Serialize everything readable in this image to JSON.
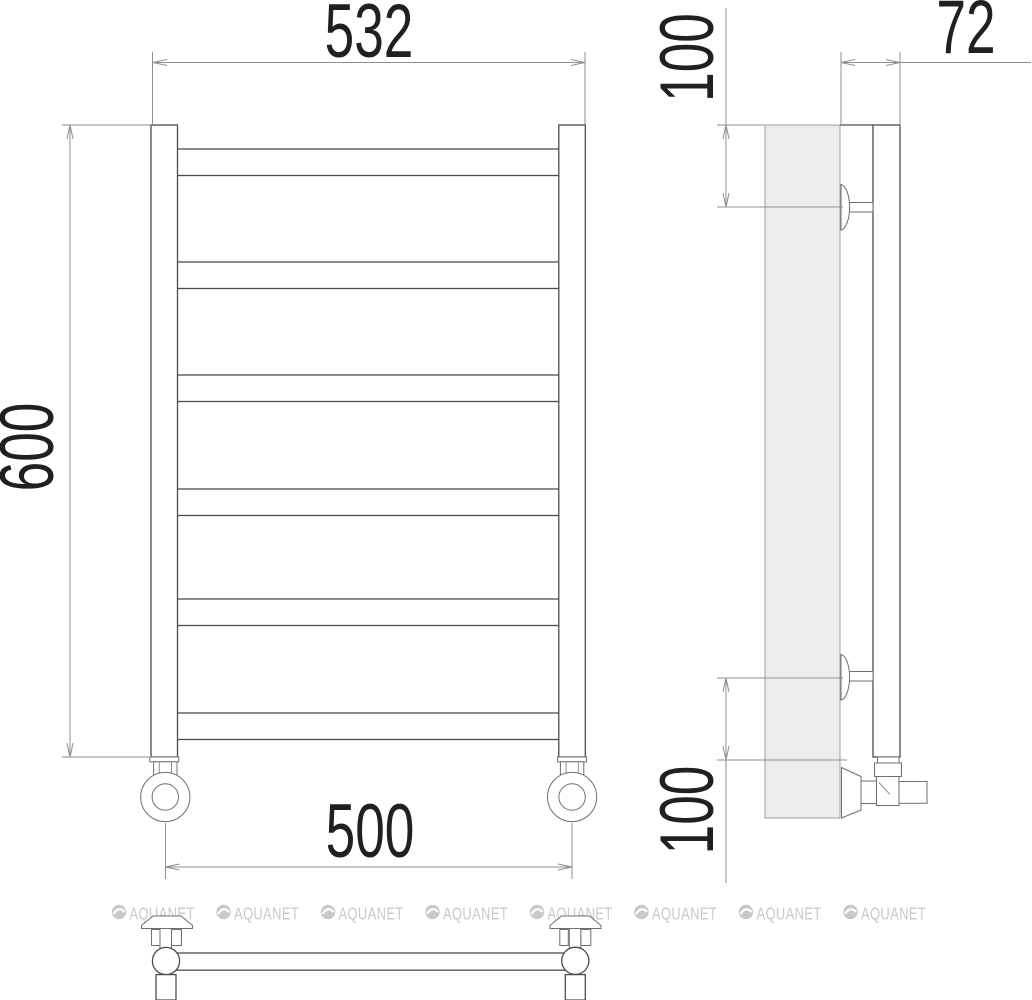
{
  "dimensions": {
    "top_width": "532",
    "left_height": "600",
    "bottom_width": "500",
    "side_depth": "72",
    "side_offset_top": "100",
    "side_offset_bottom": "100"
  },
  "watermark": {
    "text": "AQUANET",
    "color": "#c9c9c9"
  },
  "colors": {
    "background": "#ffffff",
    "object_line": "#4d4d4d",
    "dimension_line": "#8f8f8f",
    "dimension_text": "#202020",
    "panel_fill": "#ececec",
    "panel_stroke": "#9e9e9e"
  }
}
